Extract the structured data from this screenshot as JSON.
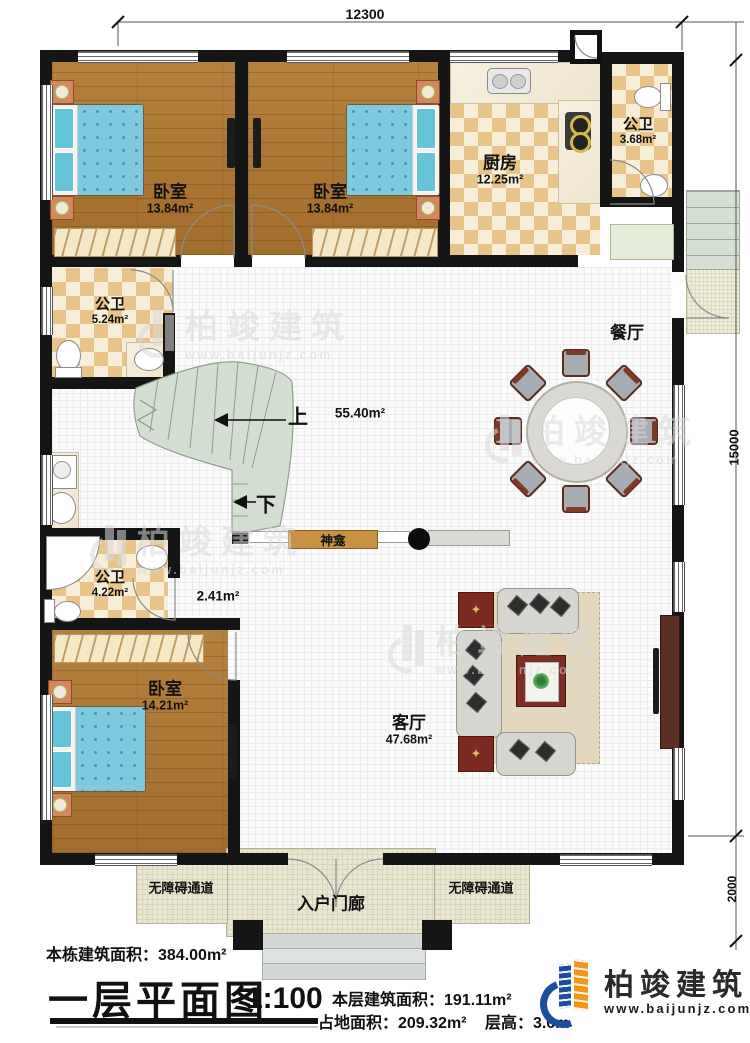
{
  "dimensions": {
    "top": "12300",
    "right": "15000",
    "bottom_right": "2000"
  },
  "rooms": {
    "bedroom1": {
      "label": "卧室",
      "area": "13.84m²"
    },
    "bedroom2": {
      "label": "卧室",
      "area": "13.84m²"
    },
    "bedroom3": {
      "label": "卧室",
      "area": "14.21m²"
    },
    "kitchen": {
      "label": "厨房",
      "area": "12.25m²"
    },
    "bath_top": {
      "label": "公卫",
      "area": "3.68m²"
    },
    "bath_mid": {
      "label": "公卫",
      "area": "5.24m²"
    },
    "bath_low": {
      "label": "公卫",
      "area": "4.22m²"
    },
    "dining": {
      "label": "餐厅"
    },
    "living": {
      "label": "客厅",
      "area": "47.68m²"
    },
    "hall": {
      "area": "55.40m²"
    },
    "corridor": {
      "area": "2.41m²"
    },
    "shrine": {
      "label": "神龛"
    },
    "porch": {
      "label": "入户门廊"
    },
    "ramp_left": {
      "label": "无障碍通道"
    },
    "ramp_right": {
      "label": "无障碍通道"
    },
    "stairs": {
      "up": "上",
      "down": "下"
    }
  },
  "footer": {
    "building_area": "本栋建筑面积：384.00m²",
    "title": "一层平面图",
    "scale": "1:100",
    "floor_area": "本层建筑面积：191.11m²",
    "land_area": "占地面积：209.32m²",
    "floor_height": "层高：3.6m"
  },
  "logo": {
    "name": "柏竣建筑",
    "url": "www.baijunjz.com"
  },
  "watermark": {
    "name": "柏竣建筑",
    "url": "www.baijunjz.com"
  },
  "colors": {
    "wall": "#151515",
    "wood_floor": "#ab7734",
    "tile_check": "#e9c489",
    "stair": "#d4ded2",
    "bed": "#7fcade",
    "shrine_wood": "#c79243",
    "logo_blue": "#1c4e9e",
    "logo_orange": "#f7941d"
  }
}
